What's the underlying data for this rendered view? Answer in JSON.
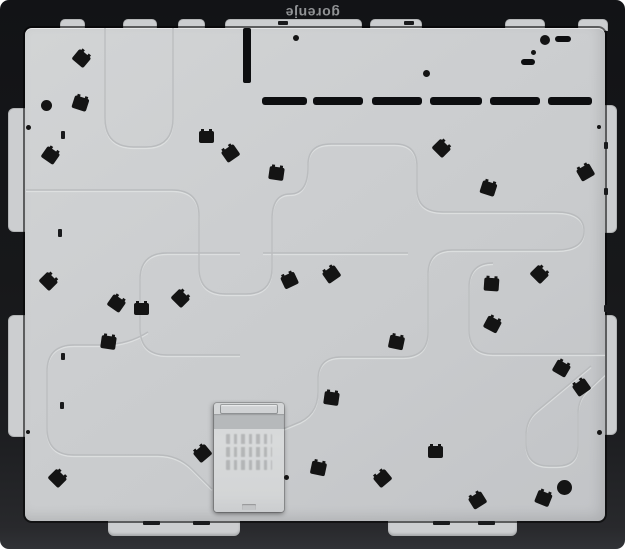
{
  "brand": {
    "text": "gorenje"
  },
  "colors": {
    "page_bg": "#ffffff",
    "frame": "#17181a",
    "panel": "#cbcdcf",
    "clip": "#141414",
    "tab": "#ccced0",
    "logo": "#919395",
    "box_rail": "#d0d2d4",
    "box_band": "#b6b9bb",
    "emboss_dark": "#b7b9bb",
    "emboss_light": "#e1e3e4"
  },
  "panel": {
    "clip_count": 30,
    "clips": [
      [
        81,
        58,
        40
      ],
      [
        80,
        103,
        18
      ],
      [
        50,
        155,
        35
      ],
      [
        206,
        137,
        0
      ],
      [
        230,
        153,
        -35
      ],
      [
        276,
        173,
        8
      ],
      [
        441,
        148,
        45
      ],
      [
        488,
        188,
        18
      ],
      [
        585,
        172,
        -30
      ],
      [
        48,
        281,
        45
      ],
      [
        116,
        303,
        35
      ],
      [
        141,
        309,
        0
      ],
      [
        108,
        342,
        8
      ],
      [
        180,
        298,
        45
      ],
      [
        289,
        280,
        -25
      ],
      [
        331,
        274,
        -35
      ],
      [
        396,
        342,
        12
      ],
      [
        491,
        284,
        4
      ],
      [
        539,
        274,
        45
      ],
      [
        492,
        324,
        28
      ],
      [
        561,
        368,
        30
      ],
      [
        581,
        387,
        -35
      ],
      [
        57,
        478,
        45
      ],
      [
        202,
        453,
        -40
      ],
      [
        331,
        398,
        8
      ],
      [
        318,
        468,
        12
      ],
      [
        382,
        478,
        -40
      ],
      [
        435,
        452,
        0
      ],
      [
        477,
        500,
        -32
      ],
      [
        543,
        498,
        22
      ]
    ],
    "dots": [
      [
        46,
        105,
        11
      ],
      [
        28,
        127,
        5
      ],
      [
        296,
        38,
        6
      ],
      [
        426,
        73,
        7
      ],
      [
        533,
        52,
        5
      ],
      [
        545,
        40,
        10
      ],
      [
        599,
        127,
        4
      ],
      [
        28,
        432,
        4
      ],
      [
        286,
        477,
        5
      ],
      [
        564,
        487,
        15
      ],
      [
        599,
        432,
        5
      ]
    ],
    "pill_slots": [
      [
        555,
        36,
        16,
        6
      ],
      [
        521,
        59,
        14,
        6
      ]
    ],
    "vent_dashes": {
      "y": 97,
      "h": 8,
      "segments": [
        [
          262,
          45
        ],
        [
          313,
          50
        ],
        [
          372,
          50
        ],
        [
          430,
          52
        ],
        [
          490,
          50
        ],
        [
          548,
          44
        ]
      ]
    },
    "vertical_slot": {
      "x": 243,
      "y": 28,
      "w": 8,
      "h": 55
    },
    "edge_marks": [
      [
        61,
        131,
        4,
        8
      ],
      [
        58,
        229,
        4,
        8
      ],
      [
        61,
        353,
        4,
        7
      ],
      [
        60,
        402,
        4,
        7
      ],
      [
        604,
        142,
        4,
        7
      ],
      [
        604,
        188,
        4,
        7
      ],
      [
        604,
        305,
        4,
        7
      ],
      [
        278,
        21,
        10,
        4
      ],
      [
        404,
        21,
        10,
        4
      ]
    ],
    "tabs": {
      "top": [
        [
          60,
          25
        ],
        [
          123,
          34
        ],
        [
          178,
          27
        ],
        [
          225,
          137
        ],
        [
          370,
          52
        ],
        [
          505,
          40
        ],
        [
          578,
          30
        ]
      ],
      "left": [
        [
          108,
          124
        ],
        [
          315,
          122
        ]
      ],
      "right": [
        [
          105,
          128
        ],
        [
          315,
          120
        ]
      ],
      "bottom": [
        [
          108,
          132
        ],
        [
          388,
          129
        ]
      ],
      "bottom_marks": [
        [
          143,
          17
        ],
        [
          193,
          17
        ],
        [
          433,
          17
        ],
        [
          478,
          17
        ]
      ]
    },
    "junction_box": {
      "x": 214,
      "y": 403,
      "w": 70,
      "h": 109,
      "label_rows": 3
    }
  }
}
